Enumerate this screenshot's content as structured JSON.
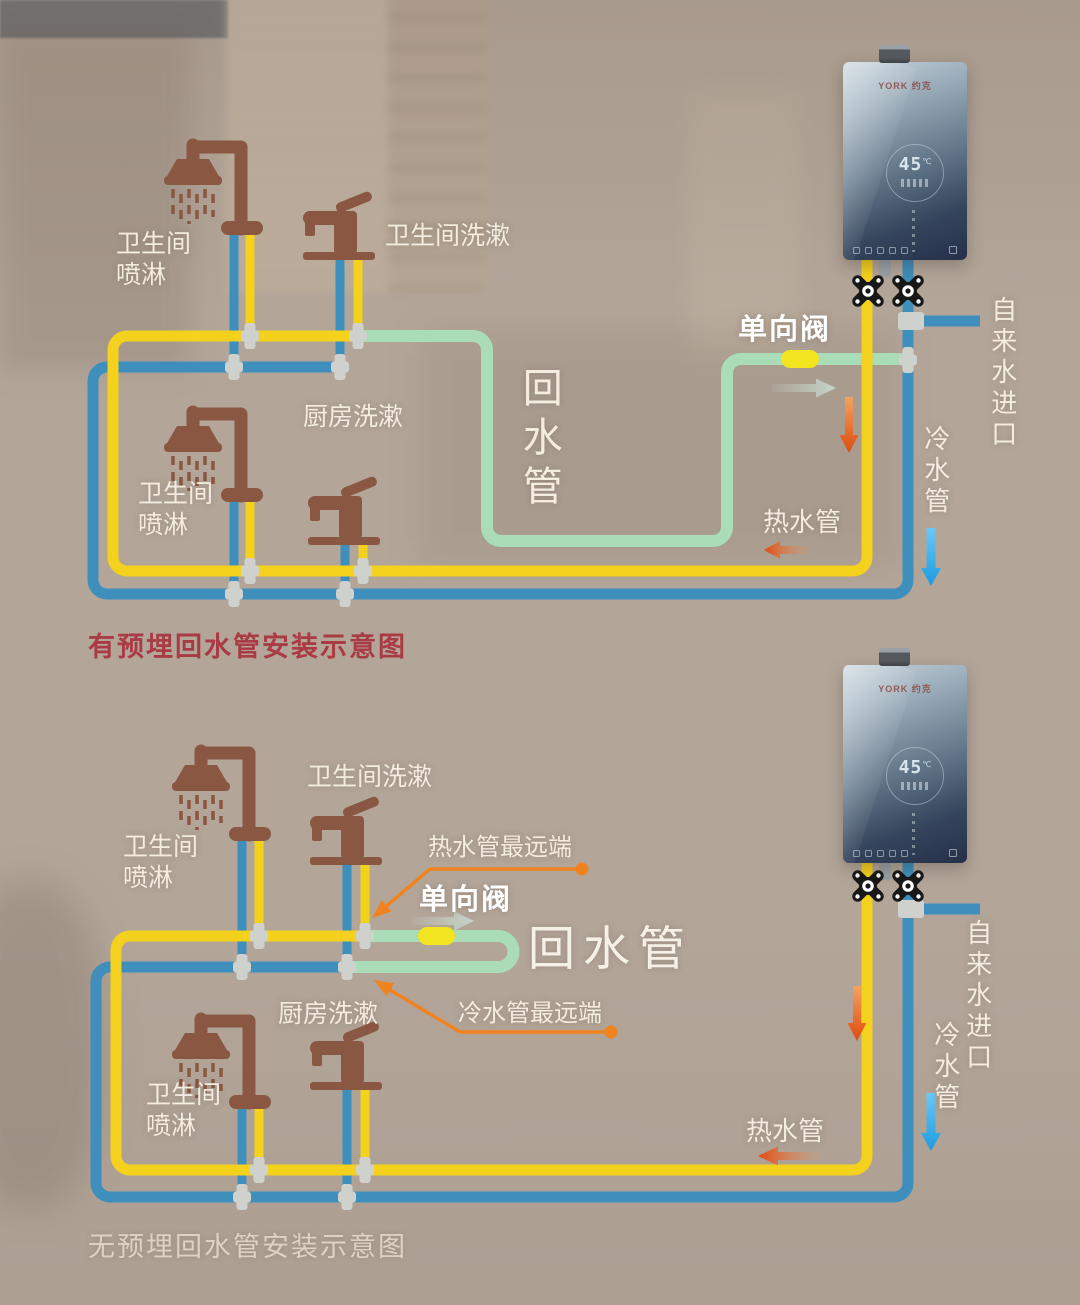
{
  "colors": {
    "bg": "#B3A699",
    "hot": "#F4D11C",
    "cold": "#3E8FBC",
    "return_pipe": "#A9DCB7",
    "valve_body": "#F2E41F",
    "fitting": "#CFD1CC",
    "fixture_brown": "#8A5743",
    "caption_red": "#A93B45",
    "label_white": "#F3ECDF",
    "leader_orange": "#F0831F",
    "arrow_red": "#DF4A0E",
    "arrow_blue": "#2BA5E8",
    "arrow_pale": "#C6D6CA"
  },
  "top_diagram": {
    "caption": "有预埋回水管安装示意图",
    "labels": {
      "shower1": "卫生间\n喷淋",
      "sink": "卫生间洗漱",
      "kitchen": "厨房洗漱",
      "shower2": "卫生间\n喷淋",
      "return_pipe": "回水管",
      "check_valve": "单向阀",
      "hot_pipe": "热水管",
      "cold_pipe": "冷水管",
      "tap_inlet": "自来水进口"
    }
  },
  "bottom_diagram": {
    "caption": "无预埋回水管安装示意图",
    "labels": {
      "shower1": "卫生间\n喷淋",
      "sink": "卫生间洗漱",
      "kitchen": "厨房洗漱",
      "shower2": "卫生间\n喷淋",
      "return_pipe": "回水管",
      "check_valve": "单向阀",
      "hot_pipe": "热水管",
      "cold_pipe": "冷水管",
      "tap_inlet": "自来水进口",
      "hot_far_end": "热水管最远端",
      "cold_far_end": "冷水管最远端"
    }
  },
  "heater": {
    "brand": "YORK 约克",
    "temp": "45",
    "unit": "℃"
  }
}
